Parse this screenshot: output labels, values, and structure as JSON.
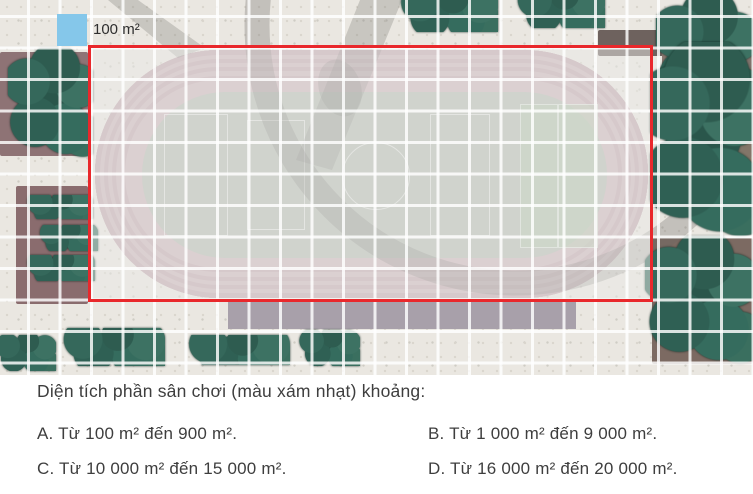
{
  "legend": {
    "label": "100 m²",
    "square_color": "#85c7ea"
  },
  "map": {
    "outline_color": "#e9282c",
    "grid_line_color": "#ffffff",
    "highlight": "light-gray playground wash inside red outline"
  },
  "question": {
    "text": "Diện tích phần sân chơi (màu xám nhạt) khoảng:"
  },
  "options": [
    {
      "key": "A",
      "label": "A. Từ 100 m² đến 900 m²."
    },
    {
      "key": "B",
      "label": "B. Từ 1 000 m² đến 9 000 m²."
    },
    {
      "key": "C",
      "label": "C. Từ 10 000 m² đến 15 000 m²."
    },
    {
      "key": "D",
      "label": "D. Từ 16 000 m² đến 20 000 m²."
    }
  ]
}
